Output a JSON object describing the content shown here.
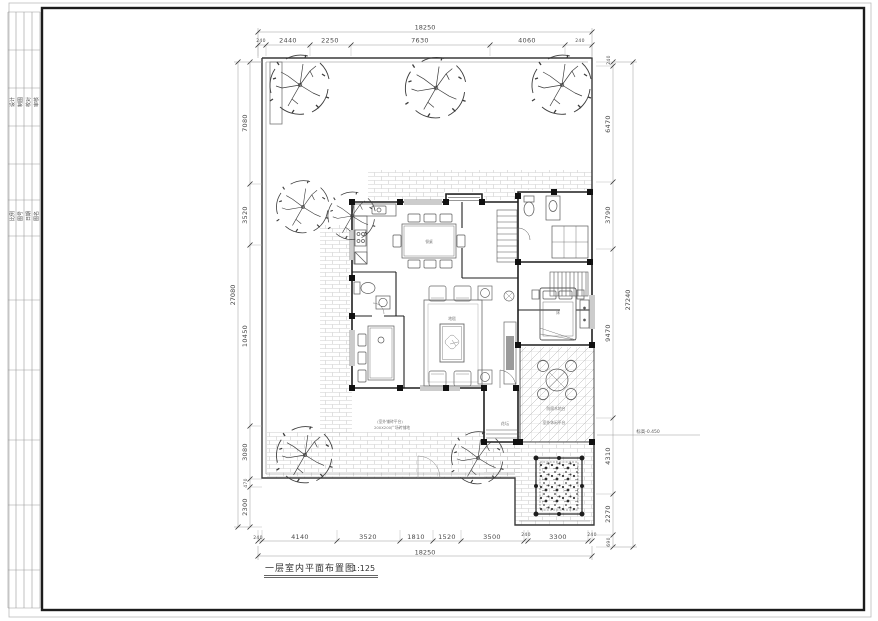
{
  "sheet": {
    "bg": "#ffffff",
    "frame_color": "#1c1c1c",
    "line_color": "#2a2a2a",
    "brick_color": "#cccccc",
    "dim_color": "#666666"
  },
  "title_block": {
    "rows_a": [
      "设计",
      "制图",
      "校对",
      "审核"
    ],
    "rows_b": [
      "比例",
      "图号",
      "日期",
      "图名"
    ]
  },
  "dims": {
    "top": {
      "overall": "18250",
      "segs": [
        "240",
        "2440",
        "2250",
        "7630",
        "4060",
        "240"
      ]
    },
    "bottom": {
      "overall": "18250",
      "segs": [
        "240",
        "4140",
        "3520",
        "1810",
        "1520",
        "3500",
        "240",
        "3300",
        "240"
      ]
    },
    "left": {
      "overall": "27080",
      "segs": [
        "7080",
        "3520",
        "10450",
        "3080",
        "470",
        "2300"
      ]
    },
    "right": {
      "overall": "27240",
      "segs": [
        "240",
        "6470",
        "3790",
        "9470",
        "4310",
        "2270",
        "690"
      ]
    }
  },
  "plan": {
    "title": "一层室内平面布置图",
    "scale": "1:125"
  },
  "annotations": {
    "level": "标高-0.450",
    "paving_line1": "(室外铺砖平台)",
    "paving_line2": "200X200广场砖铺地",
    "terrace_label1": "防腐木地台",
    "terrace_label2": "室外休闲平台",
    "flowerbed": "花坛",
    "dining_table": "餐桌",
    "rug": "地毯",
    "bed": "床"
  }
}
